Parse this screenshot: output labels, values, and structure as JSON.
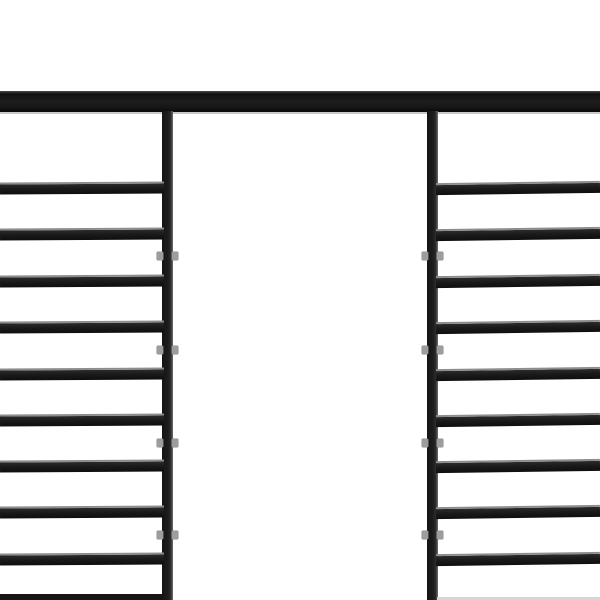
{
  "scene": {
    "description": "Close-up product photo of a black steel pergola frame on a white background: full-width top beam, two vertical posts, horizontal roof slats on left and right panels, open white gap between the posts",
    "background_color": "#ffffff",
    "frame_color": "#1c1c1c",
    "beam_highlight_color": "#c9c9c9",
    "slat_edge_highlight_color": "#8d8d8d",
    "bracket_color": "#9d9d9d",
    "bottom_right_faint_strip_color": "#d6d6d6"
  },
  "beam": {
    "x": 0,
    "y": 91,
    "width": 600,
    "height": 21
  },
  "beam_underline": {
    "x": 0,
    "y": 112,
    "width": 600,
    "height": 2
  },
  "posts": [
    {
      "name": "left-post",
      "x": 162,
      "y": 111,
      "width": 11,
      "height": 489
    },
    {
      "name": "right-post",
      "x": 427,
      "y": 111,
      "width": 11,
      "height": 489
    }
  ],
  "left_panel": {
    "slat_x": 0,
    "slat_width": 164,
    "slat_height": 12,
    "slat_tops": [
      182,
      228,
      275,
      321,
      368,
      414,
      460,
      506,
      553
    ],
    "bottom_partial_slat": {
      "x": 0,
      "y": 594,
      "width": 164,
      "height": 6
    }
  },
  "right_panel": {
    "slat_x": 436,
    "slat_width": 164,
    "slat_height": 12,
    "slat_tops": [
      182,
      228,
      275,
      321,
      368,
      414,
      460,
      506,
      553
    ],
    "bottom_faint_strip": {
      "x": 437,
      "y": 597,
      "width": 163,
      "height": 3
    }
  },
  "bracket_clips": {
    "center_ys": [
      256,
      350,
      443,
      535
    ],
    "clip_width": 6,
    "clip_height": 8
  }
}
